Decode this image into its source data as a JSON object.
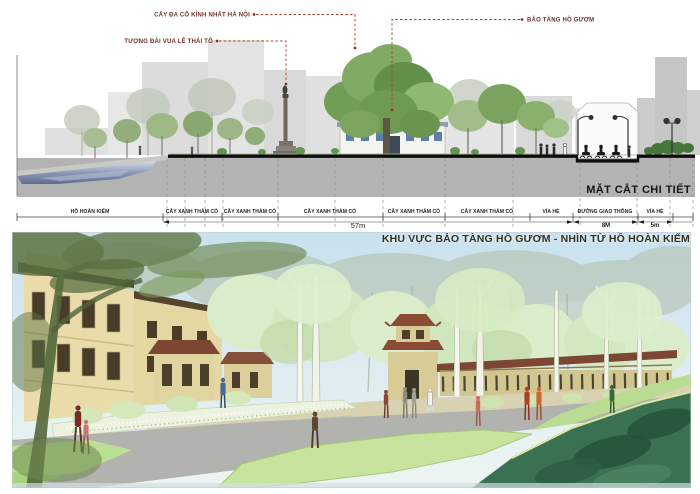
{
  "annotations": {
    "banyan_label": "CÂY ĐA CỔ KÍNH NHẤT HÀ NỘI",
    "statue_label": "TƯỢNG ĐÀI VUA LÊ THÁI TỔ",
    "museum_label": "BẢO TÀNG HỒ GƯƠM"
  },
  "section": {
    "title": "MẶT CẮT CHI TIẾT"
  },
  "scale": {
    "segments": [
      {
        "label": "HỒ HOÀN KIẾM"
      },
      {
        "label": "CÂY XANH THẢM CỎ"
      },
      {
        "label": "CÂY XANH THẢM CỎ"
      },
      {
        "label": "CÂY XANH THẢM CỎ"
      },
      {
        "label": "CÂY XANH THẢM CỎ"
      },
      {
        "label": "CÂY XANH THẢM CỎ"
      },
      {
        "label": "VỈA HÈ"
      },
      {
        "label": "ĐƯỜNG GIAO THÔNG"
      },
      {
        "label": "VỈA HÈ"
      }
    ],
    "dimensions": [
      {
        "label": "57m"
      },
      {
        "label": "8M"
      },
      {
        "label": "5m"
      }
    ]
  },
  "perspective": {
    "title": "KHU VỰC BẢO TÀNG HỒ GƯƠM - NHÌN TỪ HỒ HOÀN KIẾM"
  },
  "colors": {
    "annotation_red": "#b5392c",
    "label_maroon": "#6d3226",
    "underground_gray": "#b3b3b3",
    "water_blue": "#8794b2",
    "canopy_green": "#729d57",
    "pale_tree_green": "#dcefcd",
    "lake_dark_green": "#3a7152",
    "building_cream": "#e8dcaa",
    "roof_redbrown": "#8a4a34"
  }
}
